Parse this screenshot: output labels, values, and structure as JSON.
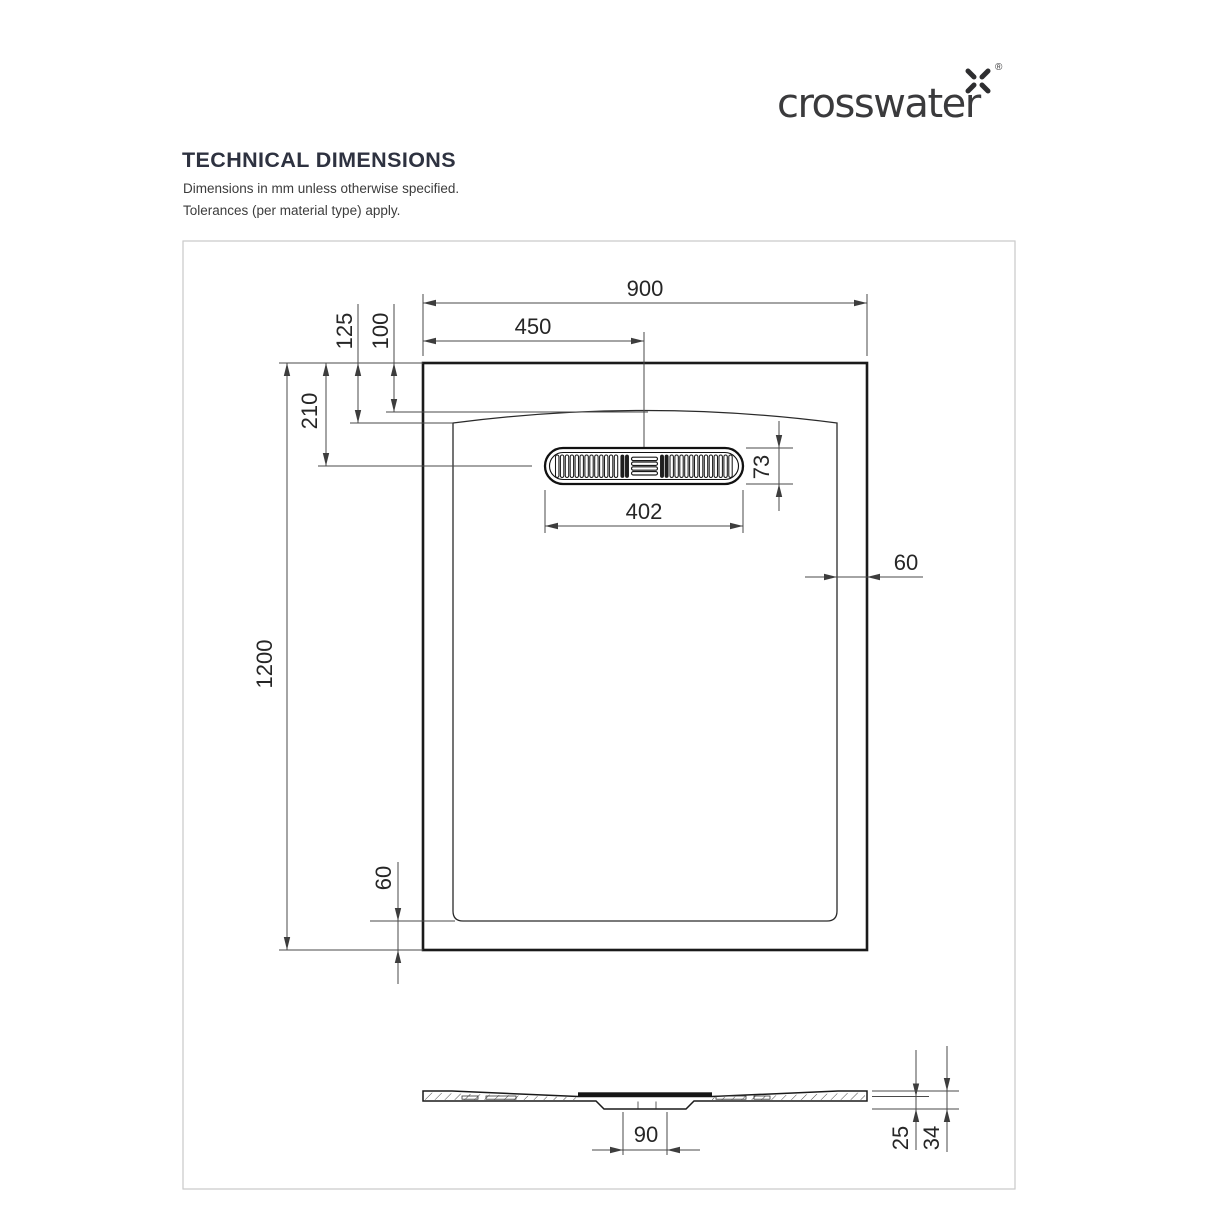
{
  "logo": {
    "brand": "crosswater",
    "registered": "®"
  },
  "header": {
    "title": "TECHNICAL DIMENSIONS",
    "note_units": "Dimensions in mm unless otherwise specified.",
    "note_tolerances": "Tolerances (per material type) apply."
  },
  "drawing": {
    "units": "mm",
    "plan_view": {
      "tray_width": "900",
      "drain_offset_from_left": "450",
      "rim_to_arc_end": "125",
      "rim_to_arc_apex": "100",
      "rim_to_drain_center": "210",
      "tray_length": "1200",
      "grille_width": "402",
      "grille_height": "73",
      "edge_gap_right": "60",
      "edge_gap_bottom": "60"
    },
    "section_view": {
      "waste_outlet_width": "90",
      "depth_at_lip": "25",
      "overall_depth": "34"
    },
    "colors": {
      "outline": "#1a1a1a",
      "dimension_lines": "#4a4a4a",
      "border": "#c9c9c9",
      "heading_text": "#2e3240",
      "brand_text": "#3a3a3c"
    }
  }
}
